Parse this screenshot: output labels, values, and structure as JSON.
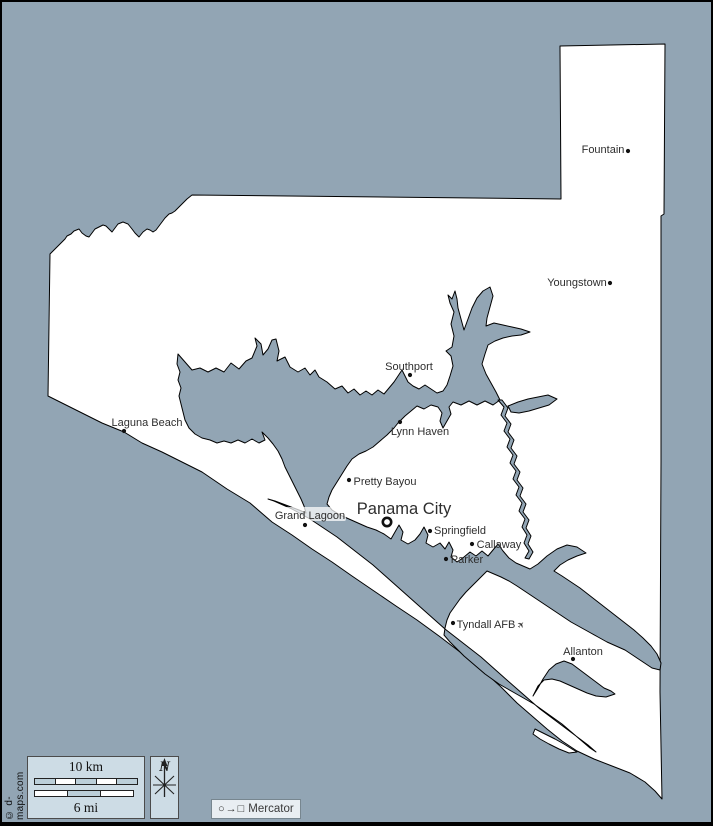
{
  "map": {
    "colors": {
      "background_water": "#92a5b4",
      "land": "#ffffff",
      "outline": "#000000",
      "panel_fill": "#cddce5",
      "label_text": "#2e2e2e"
    },
    "towns": [
      {
        "name": "Fountain",
        "dot": [
          626,
          149
        ],
        "label": [
          601,
          147
        ],
        "size": 11,
        "marker": "dot"
      },
      {
        "name": "Youngstown",
        "dot": [
          608,
          281
        ],
        "label": [
          575,
          280
        ],
        "size": 11,
        "marker": "dot"
      },
      {
        "name": "Southport",
        "dot": [
          408,
          373
        ],
        "label": [
          407,
          364
        ],
        "size": 11,
        "marker": "dot"
      },
      {
        "name": "Lynn Haven",
        "dot": [
          398,
          420
        ],
        "label": [
          418,
          429
        ],
        "size": 11,
        "marker": "dot"
      },
      {
        "name": "Laguna Beach",
        "dot": [
          122,
          429
        ],
        "label": [
          145,
          420
        ],
        "size": 11,
        "marker": "dot"
      },
      {
        "name": "Pretty Bayou",
        "dot": [
          347,
          478
        ],
        "label": [
          383,
          479
        ],
        "size": 11,
        "marker": "dot"
      },
      {
        "name": "Panama City",
        "dot": [
          385,
          520
        ],
        "label": [
          402,
          508
        ],
        "size": 16.5,
        "marker": "ring"
      },
      {
        "name": "Grand Lagoon",
        "dot": [
          303,
          523
        ],
        "label": [
          308,
          513
        ],
        "size": 11,
        "marker": "dot",
        "plate": true
      },
      {
        "name": "Springfield",
        "dot": [
          428,
          529
        ],
        "label": [
          458,
          528
        ],
        "size": 11,
        "marker": "dot"
      },
      {
        "name": "Callaway",
        "dot": [
          470,
          542
        ],
        "label": [
          497,
          542
        ],
        "size": 11,
        "marker": "dot"
      },
      {
        "name": "Parker",
        "dot": [
          444,
          557
        ],
        "label": [
          465,
          557
        ],
        "size": 11,
        "marker": "dot"
      },
      {
        "name": "Tyndall AFB",
        "dot": [
          451,
          621
        ],
        "label": [
          484,
          622
        ],
        "size": 11,
        "marker": "dot",
        "icon": "airport-icon",
        "icon_glyph": "✈",
        "icon_pos": [
          519,
          623
        ]
      },
      {
        "name": "Allanton",
        "dot": [
          571,
          657
        ],
        "label": [
          581,
          649
        ],
        "size": 11,
        "marker": "dot"
      }
    ],
    "scale": {
      "km_label": "10 km",
      "mi_label": "6 mi",
      "km_pattern": [
        "#bccfd9",
        "#ffffff",
        "#bccfd9",
        "#ffffff",
        "#bccfd9"
      ],
      "mi_pattern": [
        "#ffffff",
        "#bccfd9",
        "#ffffff"
      ]
    },
    "compass": {
      "letter": "N"
    },
    "projection": {
      "glyphs": "○→□",
      "name": "Mercator"
    },
    "attribution": "© d-maps.com"
  }
}
